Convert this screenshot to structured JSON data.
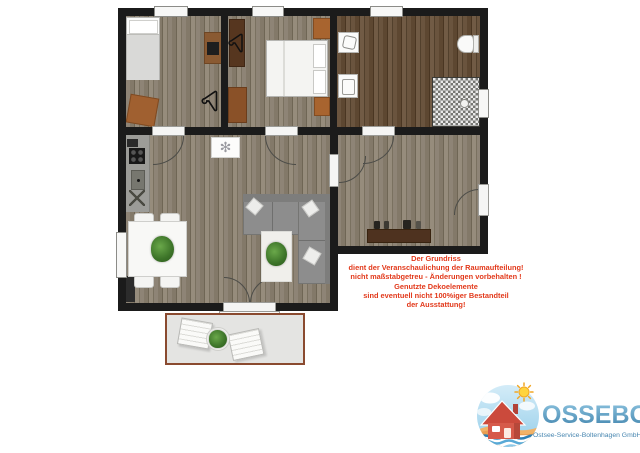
{
  "page": {
    "background": "#ffffff"
  },
  "disclaimer": {
    "color": "#e2391b",
    "lines": [
      "Der Grundriss",
      "dient der Veranschaulichung der Raumaufteilung!",
      "nicht maßstabgetreu - Änderungen vorbehalten !",
      "Genutzte Dekoelemente",
      "sind eventuell nicht 100%iger Bestandteil",
      "der Ausstattung!"
    ]
  },
  "logo": {
    "company": "OSSEBO",
    "subtitle": "Ostsee-Service-Boltenhagen GmbH",
    "brand_color": "#4786b0"
  },
  "icons": {
    "ceiling_ornament_glyph": "✻",
    "hanger_icon": "clothes-hanger",
    "plant_icon": "green-plant"
  },
  "floorplan_colors": {
    "wall": "#1b1b1b",
    "wood_floor": "#877d6d",
    "bath_floor": "#5d4731",
    "terrace_border": "#8a4a2f",
    "terrace_fill": "#e4e4e2"
  }
}
